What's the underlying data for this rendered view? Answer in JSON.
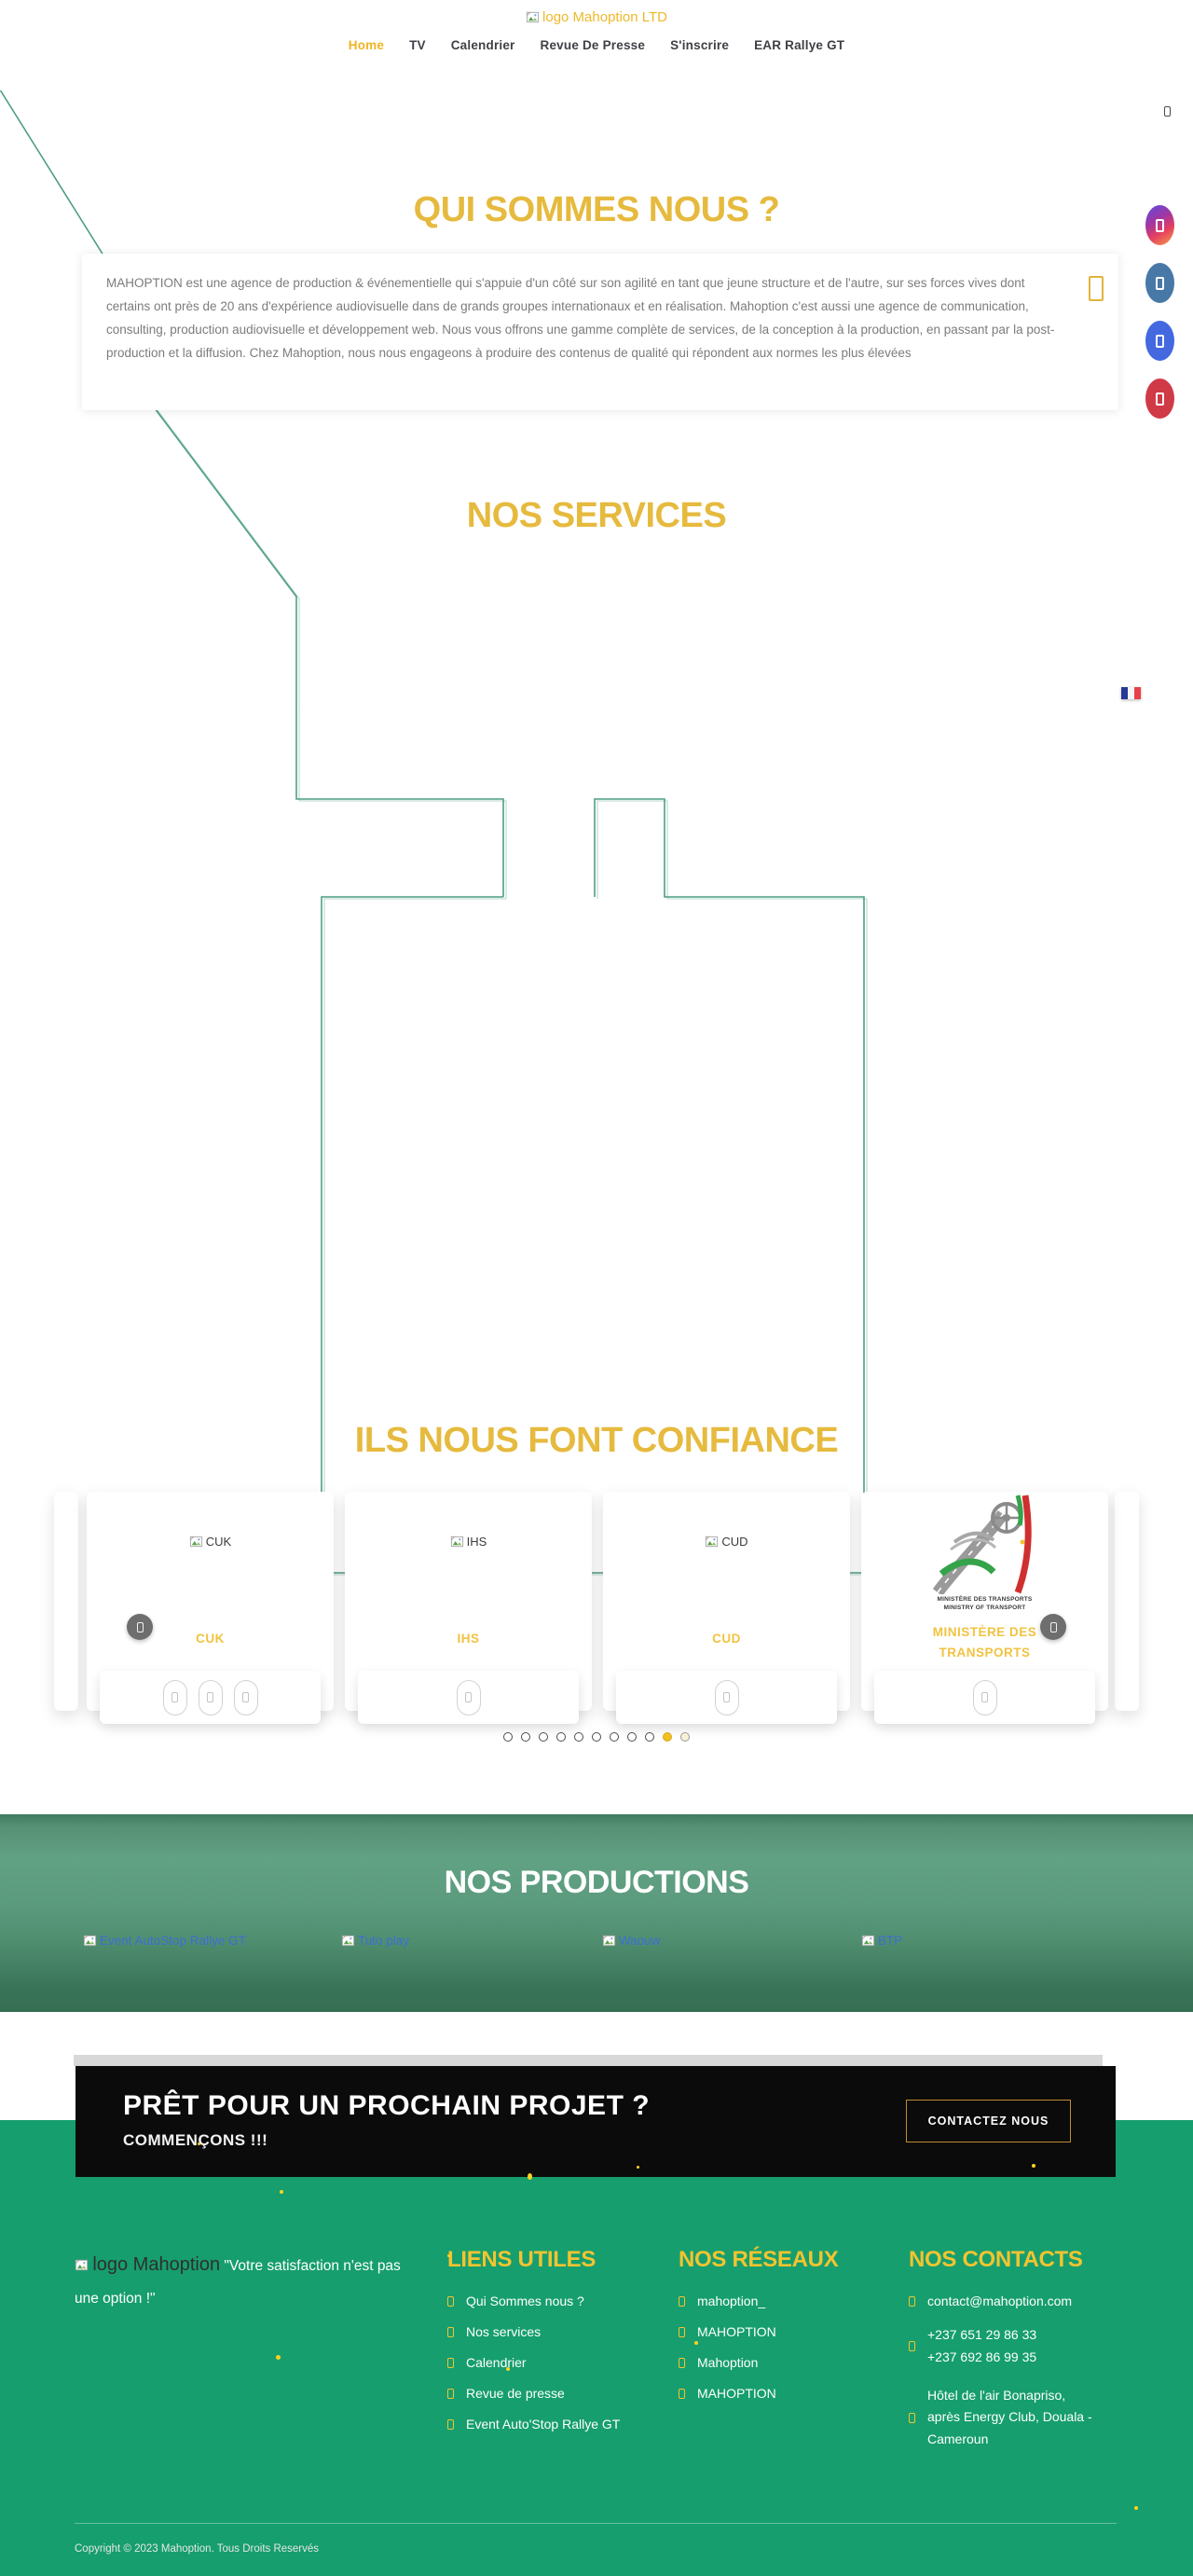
{
  "header": {
    "logo_alt": "logo Mahoption LTD",
    "nav": [
      {
        "label": "Home"
      },
      {
        "label": "TV"
      },
      {
        "label": "Calendrier"
      },
      {
        "label": "Revue De Presse"
      },
      {
        "label": "S'inscrire"
      },
      {
        "label": "EAR Rallye GT"
      }
    ]
  },
  "about": {
    "title": "QUI SOMMES NOUS ?",
    "paragraph": "MAHOPTION est une agence de production & événementielle qui s'appuie d'un côté sur son agilité en tant que jeune structure et de l'autre, sur ses forces vives dont certains ont près de 20 ans d'expérience audiovisuelle dans de grands groupes internationaux et en réalisation. Mahoption c'est aussi une agence de communication, consulting, production audiovisuelle et développement web. Nous vous offrons une gamme complète de services, de la conception à la production, en passant par la post- production et la diffusion. Chez Mahoption, nous nous engageons à produire des contenus de qualité qui répondent aux normes les plus élevées"
  },
  "services": {
    "title": "NOS SERVICES"
  },
  "clients": {
    "title": "ILS NOUS FONT CONFIANCE",
    "cards": [
      {
        "alt": "CUK",
        "label": "CUK"
      },
      {
        "alt": "IHS",
        "label": "IHS"
      },
      {
        "alt": "CUD",
        "label": "CUD"
      },
      {
        "label_line1": "MINISTÈRE DES",
        "label_line2": "TRANSPORTS",
        "img_caption1": "MINISTÈRE DES TRANSPORTS",
        "img_caption2": "MINISTRY OF TRANSPORT"
      }
    ],
    "dots_total": 11,
    "active_dot": 10
  },
  "productions": {
    "title": "NOS PRODUCTIONS",
    "links": [
      {
        "alt": "Event AutoStop Rallye GT"
      },
      {
        "alt": "Tuto play"
      },
      {
        "alt": "Waouw"
      },
      {
        "alt": "BTP"
      }
    ]
  },
  "cta": {
    "title": "PRÊT POUR UN PROCHAIN PROJET ?",
    "subtitle": "COMMENÇONS !!!",
    "button_label": "CONTACTEZ NOUS"
  },
  "footer": {
    "logo_alt": "logo Mahoption",
    "tagline": "\"Votre satisfaction n'est pas une option !\"",
    "liens": {
      "title": "LIENS UTILES",
      "items": [
        {
          "label": "Qui Sommes nous ?"
        },
        {
          "label": "Nos services"
        },
        {
          "label": "Calendrier"
        },
        {
          "label": "Revue de presse"
        },
        {
          "label": "Event Auto'Stop Rallye GT"
        }
      ]
    },
    "reseaux": {
      "title": "NOS RÉSEAUX",
      "items": [
        {
          "label": "mahoption_"
        },
        {
          "label": "MAHOPTION"
        },
        {
          "label": "Mahoption"
        },
        {
          "label": "MAHOPTION"
        }
      ]
    },
    "contacts": {
      "title": "NOS CONTACTS",
      "email": "contact@mahoption.com",
      "phone1": "+237 651 29 86 33",
      "phone2": "+237 692 86 99 35",
      "address_line1": "Hôtel de l'air Bonapriso,",
      "address_line2": "après Energy Club, Douala -",
      "address_line3": "Cameroun"
    },
    "copyright": "Copyright © 2023 Mahoption. Tous Droits Reservés"
  },
  "colors": {
    "gold_heading": "#e6ba3e",
    "footer_green": "#169e6e",
    "line_teal": "#4f9e82",
    "cta_black": "#0b0b0b",
    "link_blue": "#3b6fd1"
  }
}
